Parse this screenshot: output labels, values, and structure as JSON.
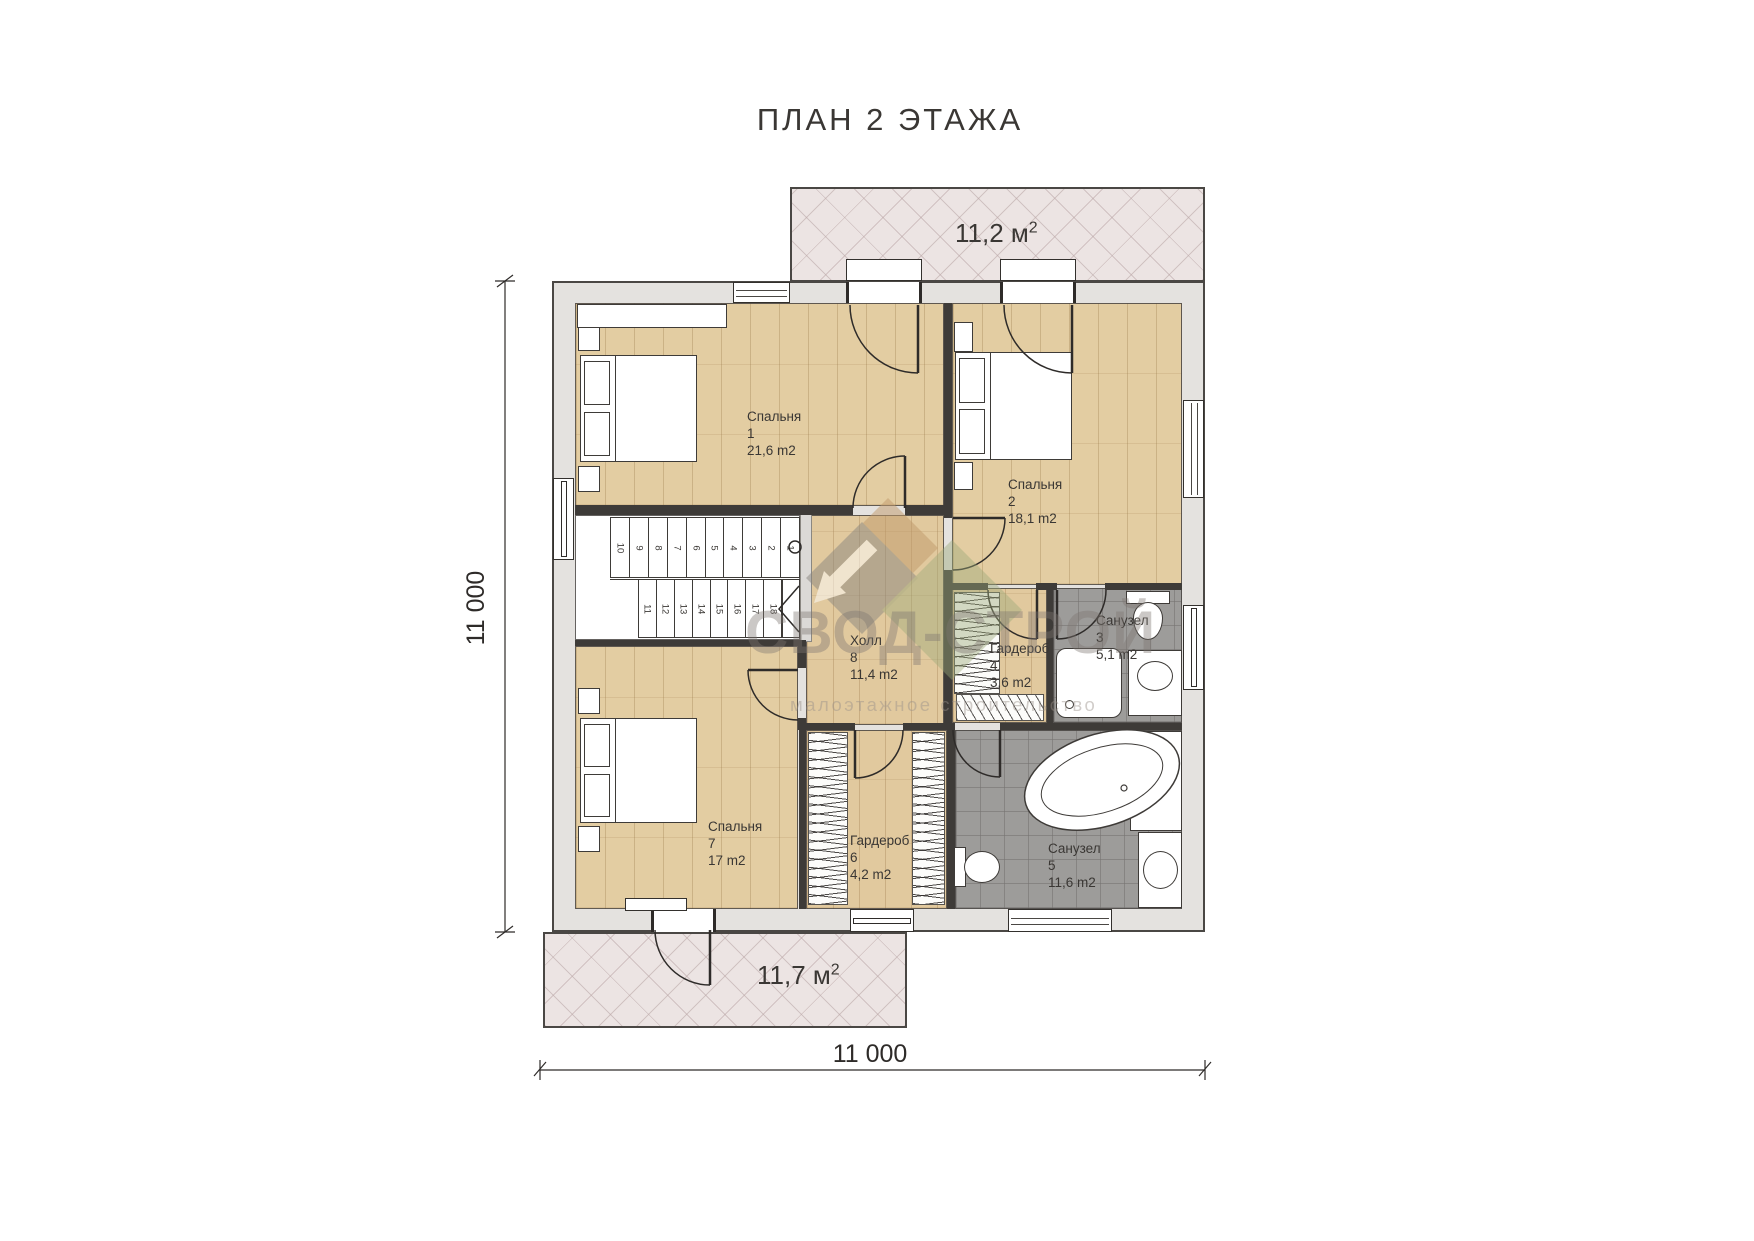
{
  "title": "ПЛАН 2 ЭТАЖА",
  "dimensions": {
    "bottom": "11 000",
    "left": "11 000"
  },
  "balconies": {
    "top": {
      "value": "11,2 м",
      "sup": "2"
    },
    "bottom": {
      "value": "11,7 м",
      "sup": "2"
    }
  },
  "rooms": [
    {
      "name": "Спальня",
      "number": "1",
      "area": "21,6 m2"
    },
    {
      "name": "Спальня",
      "number": "2",
      "area": "18,1 m2"
    },
    {
      "name": "Санузел",
      "number": "3",
      "area": "5,1 m2"
    },
    {
      "name": "Гардероб",
      "number": "4",
      "area": "3,6 m2"
    },
    {
      "name": "Санузел",
      "number": "5",
      "area": "11,6 m2"
    },
    {
      "name": "Гардероб",
      "number": "6",
      "area": "4,2 m2"
    },
    {
      "name": "Спальня",
      "number": "7",
      "area": "17 m2"
    },
    {
      "name": "Холл",
      "number": "8",
      "area": "11,4 m2"
    }
  ],
  "stairs": {
    "up": [
      "10",
      "9",
      "8",
      "7",
      "6",
      "5",
      "4",
      "3",
      "2",
      "1"
    ],
    "down": [
      "11",
      "12",
      "13",
      "14",
      "15",
      "16",
      "17",
      "18"
    ]
  },
  "watermark": {
    "brand": "СВОД-СТРОЙ",
    "tagline": "малоэтажное строительство"
  },
  "colors": {
    "wall_fill": "#e4e2df",
    "wall_line": "#3e3b38",
    "wood_floor": "#e3cda2",
    "tile_floor": "#9d9c9a",
    "balcony_fill": "#ece4e3"
  }
}
